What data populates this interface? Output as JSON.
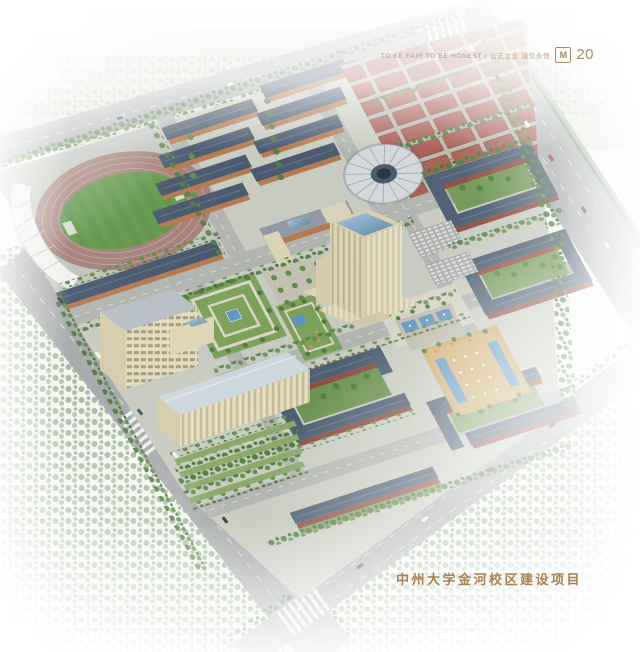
{
  "header": {
    "slogan_en": "TO BE FAIR TO BE HONEST",
    "separator": "/",
    "slogan_zh": "公正立业 诚信永恒",
    "logo_glyph": "M",
    "page_number": "20"
  },
  "caption": {
    "text": "中州大学金河校区建设项目"
  },
  "palette": {
    "gold_text": "#a98e63",
    "caption_gold": "#a8824f",
    "track_red": "#a37e76",
    "field_green": "#63984c",
    "slate_roof": "#46566b",
    "dorm_orange": "#b5764a",
    "brick_red": "#8e4a3c",
    "court_red": "#a65a50",
    "tower_cream": "#e5dcc0",
    "glass_blue": "#7fa7c4",
    "water_blue": "#5d94c0",
    "plaza_tan": "#c9a96b",
    "lawn_green": "#7da05c",
    "tree_green": "#4e7a3e",
    "road_gray": "#a4a7a8",
    "haze_white": "#ffffff"
  },
  "scene": {
    "type": "aerial-architectural-rendering",
    "features": [
      "perimeter-roads",
      "stadium",
      "running-track",
      "football-field",
      "grandstand-canopy",
      "dormitory-blocks",
      "basketball-courts",
      "gymnasium-dome",
      "teaching-block",
      "main-tower",
      "library-complex",
      "academic-clusters",
      "formal-garden",
      "fountain-plaza",
      "water-pools",
      "parking-lots",
      "tree-belts",
      "traffic",
      "haze"
    ]
  }
}
